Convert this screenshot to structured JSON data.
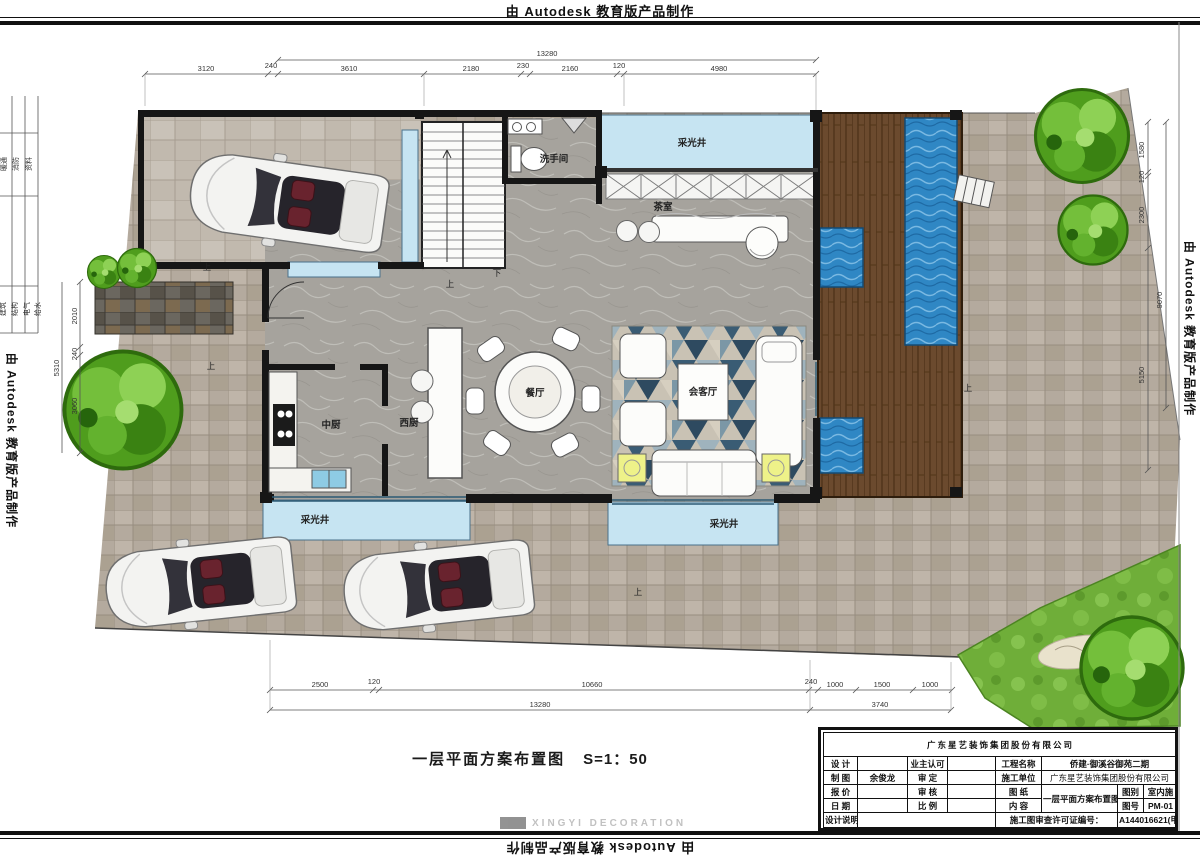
{
  "watermark": {
    "text": "由 Autodesk 教育版产品制作"
  },
  "brand_watermark": {
    "logo_text": "XINGYI DECORATION"
  },
  "caption": {
    "title": "一层平面方案布置图",
    "scale": "S=1：50"
  },
  "plan": {
    "rooms": {
      "light_well": "采光井",
      "tea_room": "茶室",
      "washroom": "洗手间",
      "dining": "餐厅",
      "chinese_kitchen": "中厨",
      "western_kitchen": "西厨",
      "living": "会客厅"
    },
    "markers": {
      "up": "上",
      "down": "下"
    },
    "dims": {
      "top_overall": "13280",
      "top": [
        "3120",
        "240",
        "3610",
        "2180",
        "230",
        "2160",
        "120",
        "4980"
      ],
      "right": [
        "1580",
        "120",
        "2300",
        "9070",
        "5150"
      ],
      "left_overall": "5310",
      "left": [
        "2010",
        "240",
        "3060"
      ],
      "bottom": [
        "2500",
        "120",
        "10660"
      ],
      "bottom_right": [
        "240",
        "1000",
        "1500",
        "1000"
      ],
      "bottom_overall": "13280",
      "bottom_right_overall": "3740"
    }
  },
  "signoff_strip": {
    "group1": [
      "暖通",
      "消防",
      "资料"
    ],
    "group2": [
      "建筑",
      "结构",
      "电气",
      "给水"
    ]
  },
  "title_block": {
    "company": "广东星艺装饰集团股份有限公司",
    "labels": {
      "design": "设 计",
      "owner_approval": "业主认可",
      "project_name": "工程名称",
      "drafting": "制 图",
      "approval": "审 定",
      "construction_unit": "施工单位",
      "quotation": "报 价",
      "review": "审 核",
      "drawing": "图 纸",
      "date": "日 期",
      "scale": "比 例",
      "content": "内 容",
      "drawing_type": "图别",
      "drawing_no": "图号",
      "design_notes": "设计说明",
      "license": "施工图审查许可证编号："
    },
    "values": {
      "project_name": "侨建·御溪谷御苑二期",
      "drafting": "余俊龙",
      "construction_unit": "广东星艺装饰集团股份有限公司",
      "drawing_content": "一层平面方案布置图",
      "drawing_type": "室内施",
      "drawing_no": "PM-01",
      "license": "A144016621(甲级)"
    }
  },
  "colors": {
    "water": "#2f87c4",
    "light_well": "#c6e4f2",
    "wood_deck": "#6b4a2e",
    "lawn": "#6fae39",
    "paving": "#b6aca0",
    "wall": "#161616",
    "rug_blue": "#3a5c74"
  }
}
